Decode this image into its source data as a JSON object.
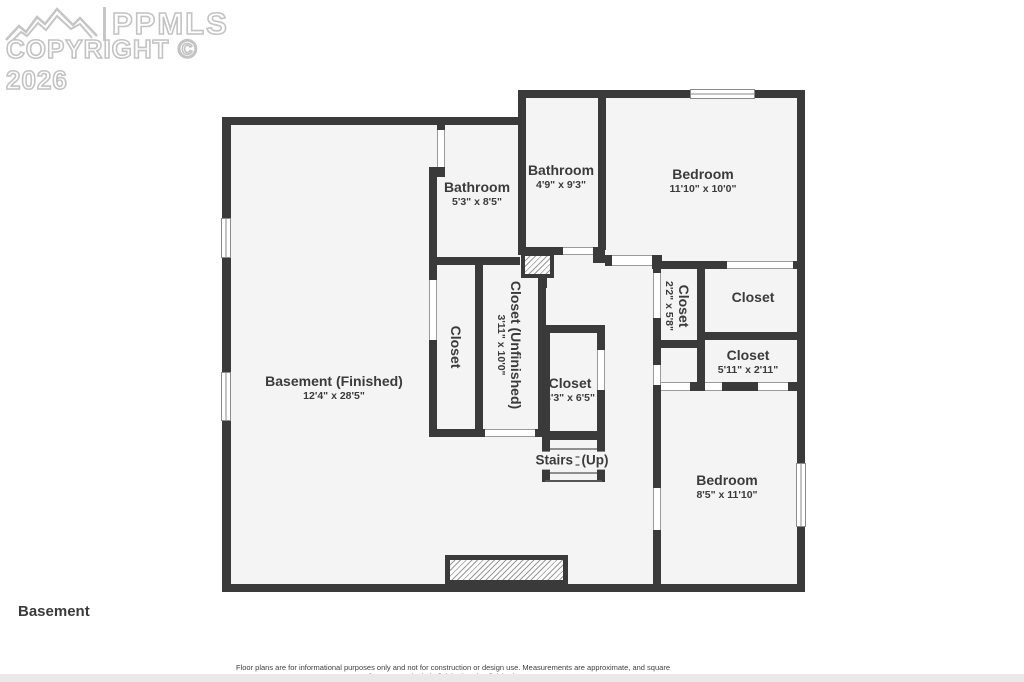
{
  "watermark": {
    "brand": "PPMLS",
    "copyright": "COPYRIGHT © 2026"
  },
  "floor_label": "Basement",
  "disclaimer": "Floor plans are for informational purposes only and not for construction or design use. Measurements are approximate, and square footage may include finished and unfinished areas.",
  "colors": {
    "wall": "#3a3a3b",
    "room_fill": "#f4f4f4",
    "label_text": "#3b3b3e",
    "watermark_gray": "#c3c3c3"
  },
  "rooms": [
    {
      "name": "Bathroom",
      "dims": "5'3\" x 8'5\""
    },
    {
      "name": "Bathroom",
      "dims": "4'9\" x 9'3\""
    },
    {
      "name": "Bedroom",
      "dims": "11'10\" x 10'0\""
    },
    {
      "name": "Closet",
      "dims": ""
    },
    {
      "name": "Closet (Unfinished)",
      "dims": "3'11\" x 10'0\""
    },
    {
      "name": "Closet",
      "dims": "2'2\" x 5'8\""
    },
    {
      "name": "Closet",
      "dims": ""
    },
    {
      "name": "Closet",
      "dims": "5'11\" x 2'11\""
    },
    {
      "name": "Closet",
      "dims": "3'3\" x 6'5\""
    },
    {
      "name": "Stairs",
      "dims": "(Up)"
    },
    {
      "name": "Basement (Finished)",
      "dims": "12'4\" x 28'5\""
    },
    {
      "name": "Bedroom",
      "dims": "8'5\" x 11'10\""
    }
  ]
}
